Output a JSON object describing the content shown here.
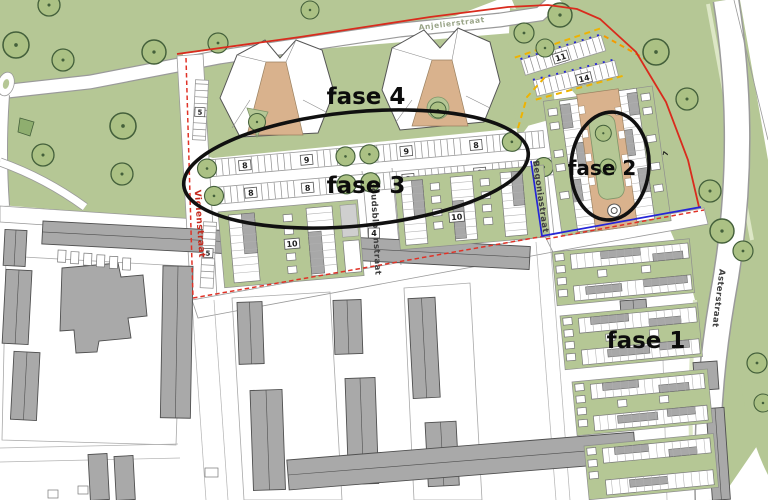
{
  "colors": {
    "park_green": "#b5c795",
    "courtyard_tan": "#d9b28d",
    "building_gray": "#a8a8a8",
    "boundary_red": "#d92b1d",
    "boundary_red_dashed": "#e03227",
    "boundary_blue": "#2525d8",
    "boundary_yellow": "#eeb302",
    "boundary_orange": "#f49a00",
    "annotation_black": "#101010",
    "street_text_red": "#c4281c"
  },
  "phases": {
    "fase1": "fase 1",
    "fase2": "fase 2",
    "fase3": "fase 3",
    "fase4": "fase 4"
  },
  "streets": {
    "violenstraat": "Violenstraat",
    "goudsbloemstraat": "Goudsbloemstraat",
    "begoniastraat": "Begoniastraat",
    "asterstraat": "Asterstraat",
    "north_street": "Anjelierstraat"
  },
  "numbers": {
    "parking_row1": [
      "8",
      "9",
      "9",
      "8"
    ],
    "parking_row2": [
      "8",
      "8",
      "8",
      "8"
    ],
    "violenstraat_bays": [
      "5",
      "5"
    ],
    "fase2_bays": [
      "11",
      "14"
    ],
    "fase2_side": "7",
    "housing_left": "10",
    "housing_right": "10",
    "goudsbloemstraat_mid": "4"
  }
}
